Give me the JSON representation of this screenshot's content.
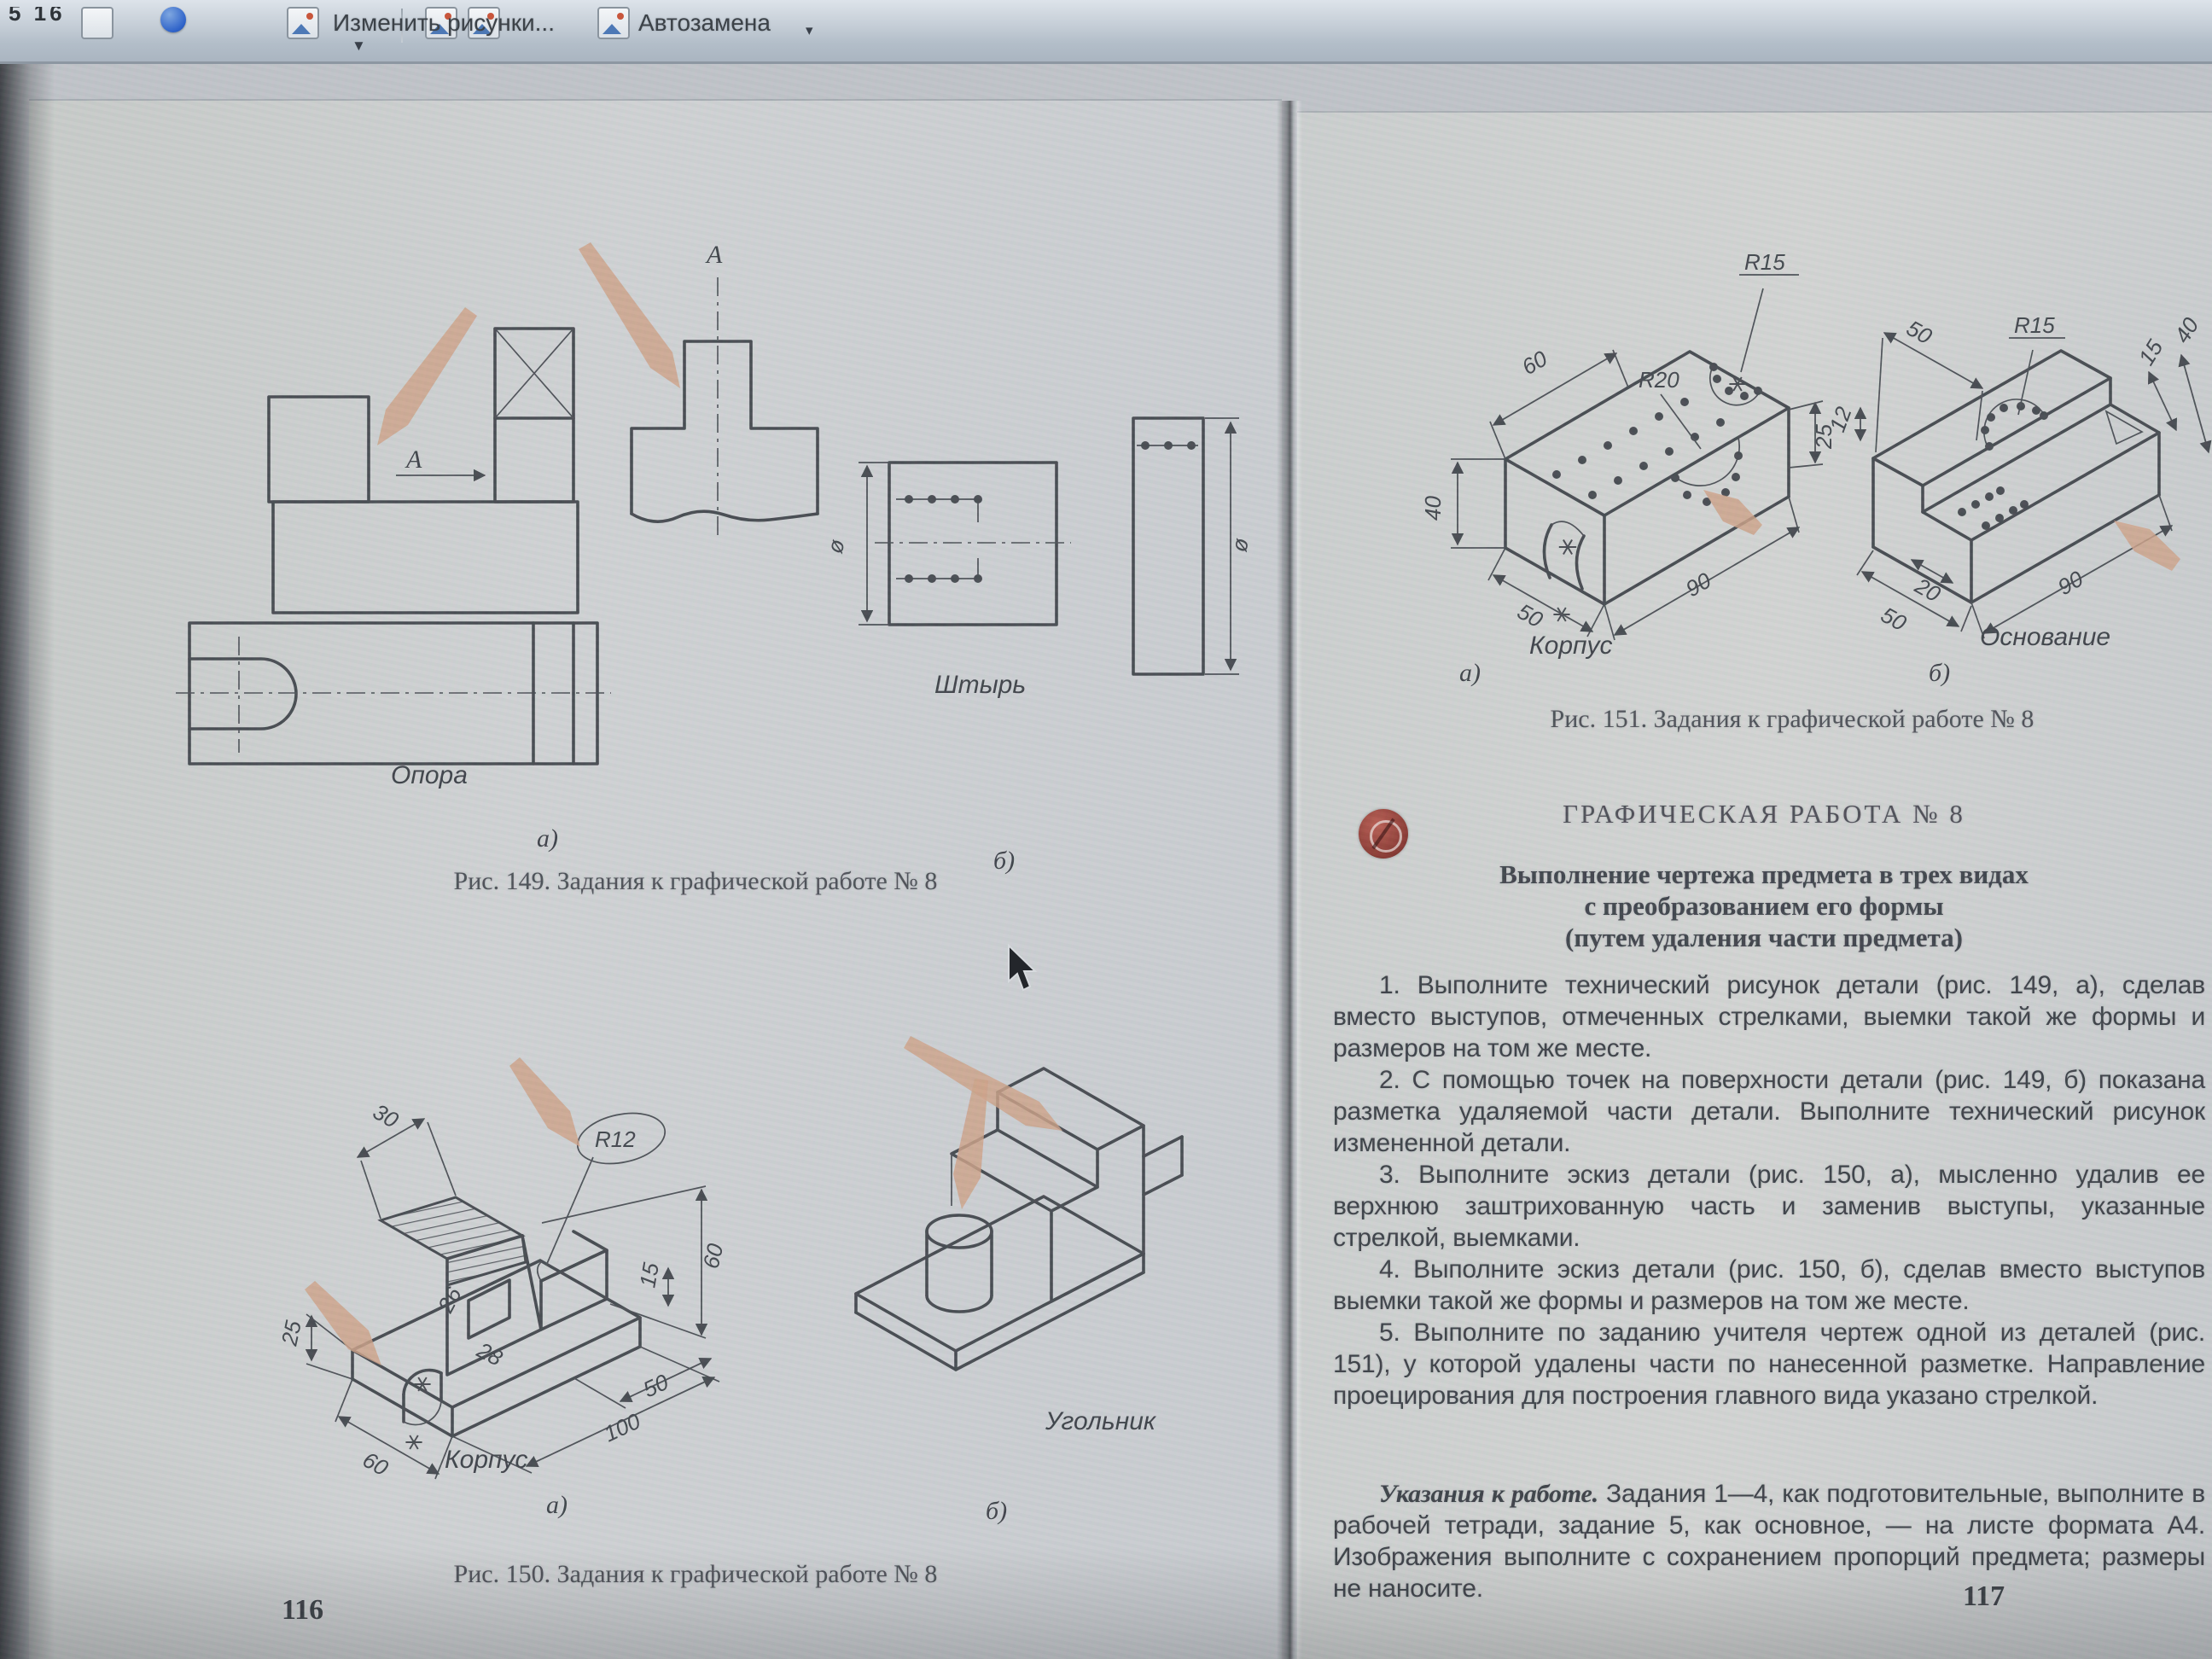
{
  "toolbar": {
    "left_fragment": "5 16",
    "edit_pictures_label": "Изменить рисунки...",
    "autocorrect_label": "Автозамена"
  },
  "left_page": {
    "page_number": "116",
    "fig149": {
      "view_arrow_label": "A",
      "view_top_label": "A",
      "part_a_name": "Опора",
      "part_a_letter": "а)",
      "part_b_name": "Штырь",
      "part_b_letter": "б)",
      "dia_left": "ø",
      "dia_right": "ø",
      "caption": "Рис. 149. Задания к графической работе № 8"
    },
    "fig150": {
      "a": {
        "name": "Корпус",
        "letter": "а)",
        "dims": {
          "d30": "30",
          "r12": "R12",
          "d60": "60",
          "d26": "26",
          "d28": "28",
          "d25": "25",
          "d15": "15",
          "d50": "50",
          "d100": "100",
          "d60b": "60"
        }
      },
      "b": {
        "name": "Угольник",
        "letter": "б)"
      },
      "caption": "Рис. 150. Задания к графической работе № 8"
    }
  },
  "right_page": {
    "page_number": "117",
    "fig151": {
      "a": {
        "name": "Корпус",
        "letter": "а)",
        "dims": {
          "d60": "60",
          "r15": "R15",
          "r20": "R20",
          "d40": "40",
          "d25": "25",
          "d90": "90",
          "d50": "50"
        }
      },
      "b": {
        "name": "Основание",
        "letter": "б)",
        "dims": {
          "d50": "50",
          "r15": "R15",
          "d12": "12",
          "d15": "15",
          "d40": "40",
          "d20": "20",
          "d50b": "50",
          "d90": "90"
        }
      },
      "caption": "Рис. 151. Задания к графической работе № 8"
    },
    "heading": "ГРАФИЧЕСКАЯ РАБОТА № 8",
    "subtitle": [
      "Выполнение чертежа предмета в трех видах",
      "с преобразованием его формы",
      "(путем удаления части предмета)"
    ],
    "paragraphs": [
      "1. Выполните технический рисунок детали (рис. 149, а), сделав вместо выступов, отмеченных стрелками, выемки такой же формы и размеров на том же месте.",
      "2. С помощью точек на поверхности детали (рис. 149, б) показана разметка удаляемой части детали. Выполните технический рисунок измененной детали.",
      "3. Выполните эскиз детали (рис. 150, а), мысленно удалив ее верхнюю заштрихованную часть и заменив выступы, указанные стрелкой, выемками.",
      "4. Выполните эскиз детали (рис. 150, б), сделав вместо выступов выемки такой же формы и размеров на том же месте.",
      "5. Выполните по заданию учителя чертеж одной из деталей (рис. 151), у которой удалены части по нанесенной разметке. Направление проецирования для построения главного вида указано стрелкой."
    ],
    "notes_lead": "Указания к работе.",
    "notes_body": " Задания 1—4, как подготовительные, выполните в рабочей тетради, задание 5, как основное, — на листе формата А4. Изображения выполните с сохранением пропорций предмета; размеры не наносите."
  }
}
